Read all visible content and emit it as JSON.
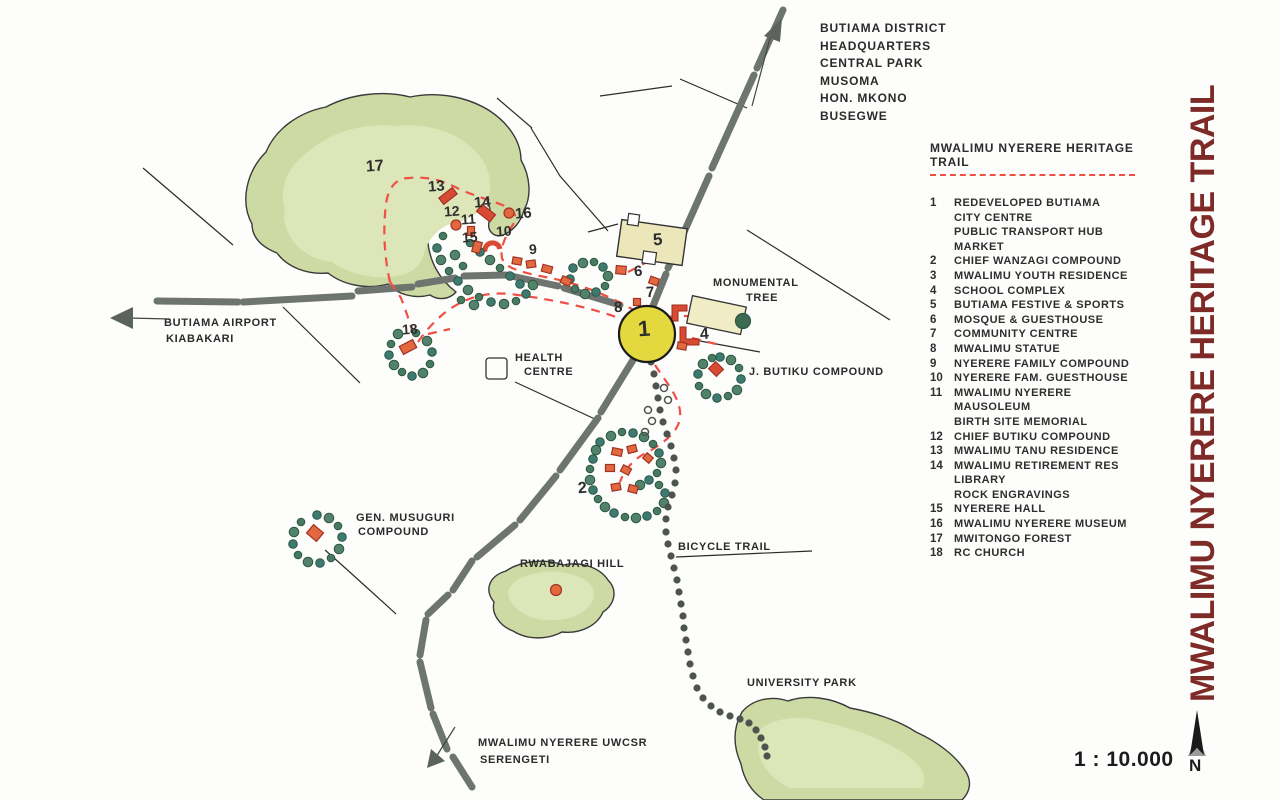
{
  "vertical_title": "MWALIMU NYERERE HERITAGE TRAIL",
  "scale": {
    "text": "1 : 10.000",
    "north_label": "N"
  },
  "colors": {
    "title_maroon": "#7e2b28",
    "trail_red": "#ef4f44",
    "road_grey": "#6e746f",
    "forest_green": "#cddaa3",
    "tree_green": "#477a60",
    "building_orange": "#e2683f",
    "building_red": "#d84a33",
    "hub_yellow": "#e3d83e"
  },
  "corner_block": {
    "lines": [
      "BUTIAMA DISTRICT",
      "HEADQUARTERS",
      "CENTRAL PARK",
      "MUSOMA",
      "HON. MKONO",
      "BUSEGWE"
    ]
  },
  "legend": {
    "heading": "MWALIMU NYERERE HERITAGE TRAIL",
    "items": [
      {
        "num": "1",
        "lines": [
          "REDEVELOPED BUTIAMA",
          "CITY CENTRE",
          "PUBLIC TRANSPORT HUB",
          "MARKET"
        ]
      },
      {
        "num": "2",
        "lines": [
          "CHIEF WANZAGI COMPOUND"
        ]
      },
      {
        "num": "3",
        "lines": [
          "MWALIMU YOUTH RESIDENCE"
        ]
      },
      {
        "num": "4",
        "lines": [
          "SCHOOL COMPLEX"
        ]
      },
      {
        "num": "5",
        "lines": [
          "BUTIAMA FESTIVE & SPORTS"
        ]
      },
      {
        "num": "6",
        "lines": [
          "MOSQUE & GUESTHOUSE"
        ]
      },
      {
        "num": "7",
        "lines": [
          "COMMUNITY CENTRE"
        ]
      },
      {
        "num": "8",
        "lines": [
          "MWALIMU STATUE"
        ]
      },
      {
        "num": "9",
        "lines": [
          "NYERERE FAMILY COMPOUND"
        ]
      },
      {
        "num": "10",
        "lines": [
          "NYERERE FAM. GUESTHOUSE"
        ]
      },
      {
        "num": "11",
        "lines": [
          "MWALIMU NYERERE",
          "MAUSOLEUM",
          "BIRTH SITE MEMORIAL"
        ]
      },
      {
        "num": "12",
        "lines": [
          "CHIEF BUTIKU COMPOUND"
        ]
      },
      {
        "num": "13",
        "lines": [
          "MWALIMU TANU RESIDENCE"
        ]
      },
      {
        "num": "14",
        "lines": [
          "MWALIMU RETIREMENT RES",
          "LIBRARY",
          "ROCK ENGRAVINGS"
        ]
      },
      {
        "num": "15",
        "lines": [
          "NYERERE HALL"
        ]
      },
      {
        "num": "16",
        "lines": [
          "MWALIMU NYERERE MUSEUM"
        ]
      },
      {
        "num": "17",
        "lines": [
          "MWITONGO FOREST"
        ]
      },
      {
        "num": "18",
        "lines": [
          "RC CHURCH"
        ]
      }
    ]
  },
  "map": {
    "labels": [
      {
        "text": "BUTIAMA AIRPORT",
        "x": 164,
        "y": 317
      },
      {
        "text": "KIABAKARI",
        "x": 166,
        "y": 333
      },
      {
        "text": "MONUMENTAL",
        "x": 713,
        "y": 277
      },
      {
        "text": "TREE",
        "x": 746,
        "y": 292
      },
      {
        "text": "HEALTH",
        "x": 515,
        "y": 352
      },
      {
        "text": "CENTRE",
        "x": 524,
        "y": 366
      },
      {
        "text": "J. BUTIKU COMPOUND",
        "x": 749,
        "y": 366
      },
      {
        "text": "GEN. MUSUGURI",
        "x": 356,
        "y": 512
      },
      {
        "text": "COMPOUND",
        "x": 358,
        "y": 526
      },
      {
        "text": "RWABAJAGI HILL",
        "x": 520,
        "y": 558
      },
      {
        "text": "BICYCLE TRAIL",
        "x": 678,
        "y": 541
      },
      {
        "text": "UNIVERSITY PARK",
        "x": 747,
        "y": 677
      },
      {
        "text": "MWALIMU NYERERE UWCSR",
        "x": 478,
        "y": 737
      },
      {
        "text": "SERENGETI",
        "x": 480,
        "y": 754
      }
    ],
    "numbers": [
      {
        "n": "17",
        "x": 366,
        "y": 158,
        "s": 16
      },
      {
        "n": "13",
        "x": 428,
        "y": 178,
        "s": 15
      },
      {
        "n": "14",
        "x": 474,
        "y": 194,
        "s": 15
      },
      {
        "n": "16",
        "x": 515,
        "y": 205,
        "s": 15
      },
      {
        "n": "12",
        "x": 444,
        "y": 203,
        "s": 14
      },
      {
        "n": "11",
        "x": 461,
        "y": 211,
        "s": 14
      },
      {
        "n": "15",
        "x": 462,
        "y": 229,
        "s": 14
      },
      {
        "n": "10",
        "x": 496,
        "y": 223,
        "s": 14
      },
      {
        "n": "9",
        "x": 529,
        "y": 241,
        "s": 14
      },
      {
        "n": "5",
        "x": 653,
        "y": 230,
        "s": 17
      },
      {
        "n": "6",
        "x": 634,
        "y": 263,
        "s": 15
      },
      {
        "n": "7",
        "x": 646,
        "y": 284,
        "s": 15
      },
      {
        "n": "8",
        "x": 614,
        "y": 299,
        "s": 15
      },
      {
        "n": "1",
        "x": 638,
        "y": 316,
        "s": 22
      },
      {
        "n": "4",
        "x": 700,
        "y": 326,
        "s": 16
      },
      {
        "n": "2",
        "x": 578,
        "y": 480,
        "s": 16
      },
      {
        "n": "18",
        "x": 402,
        "y": 321,
        "s": 14
      }
    ]
  }
}
